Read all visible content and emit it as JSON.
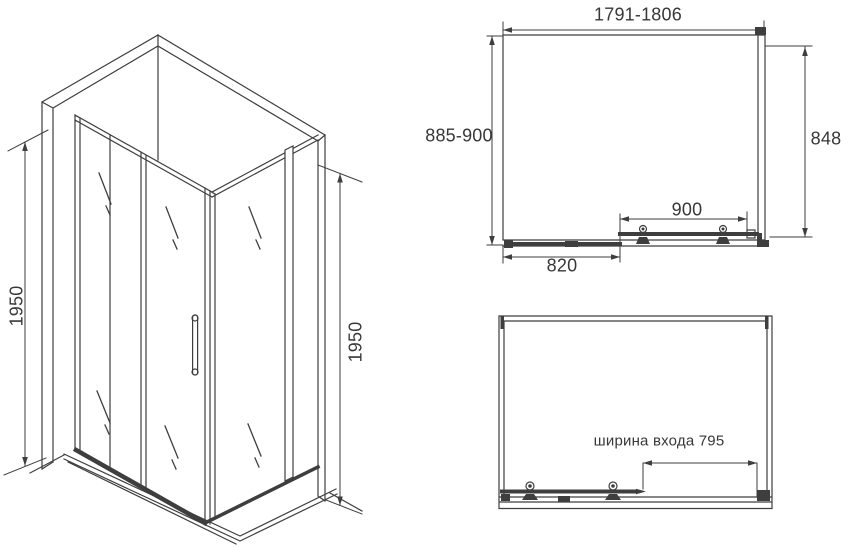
{
  "colors": {
    "line": "#3e3e3e",
    "text": "#383838",
    "background": "#ffffff"
  },
  "iso_view": {
    "height_left": "1950",
    "height_right": "1950"
  },
  "plan_view": {
    "width_range": "1791-1806",
    "depth_range": "885-900",
    "side_width": "848",
    "door_width": "900",
    "fixed_panel_width": "820"
  },
  "entry_view": {
    "entry_width_label": "ширина входа 795"
  }
}
